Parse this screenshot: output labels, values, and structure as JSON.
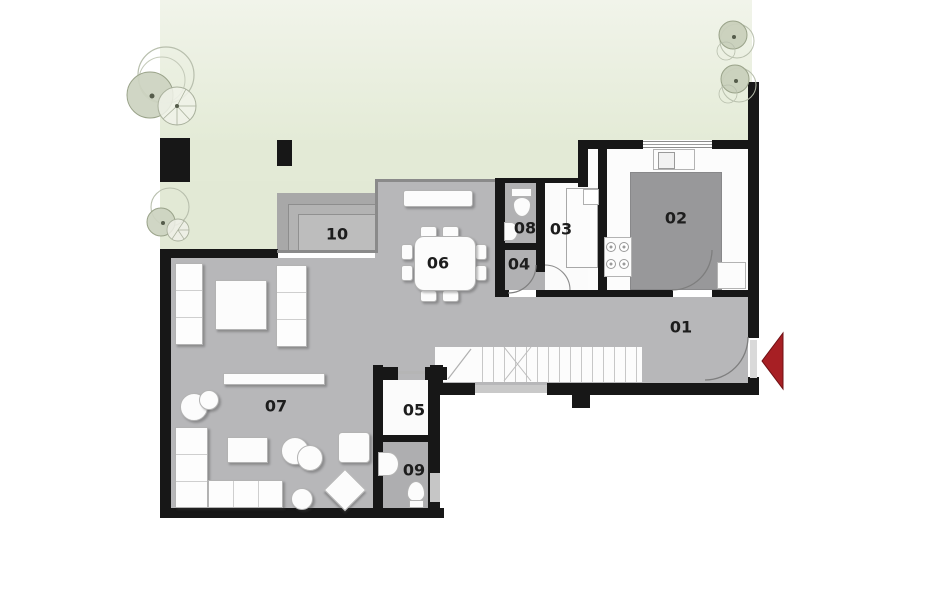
{
  "rooms": [
    {
      "number": "01"
    },
    {
      "number": "02"
    },
    {
      "number": "03"
    },
    {
      "number": "04"
    },
    {
      "number": "05"
    },
    {
      "number": "06"
    },
    {
      "number": "07"
    },
    {
      "number": "08"
    },
    {
      "number": "09"
    },
    {
      "number": "10"
    }
  ],
  "colors": {
    "garden_green": "#e6ecda",
    "floor_gray": "#b7b7b9",
    "dark_island_gray": "#98989a",
    "wall_black": "#171717",
    "terrace_gray": "#a9a9a9",
    "furniture_white": "#fcfcfc",
    "entrance_arrow_red": "#a71f24",
    "tree_green": "#ccd3c0"
  },
  "icons": {
    "entrance_marker": "left-arrow"
  }
}
